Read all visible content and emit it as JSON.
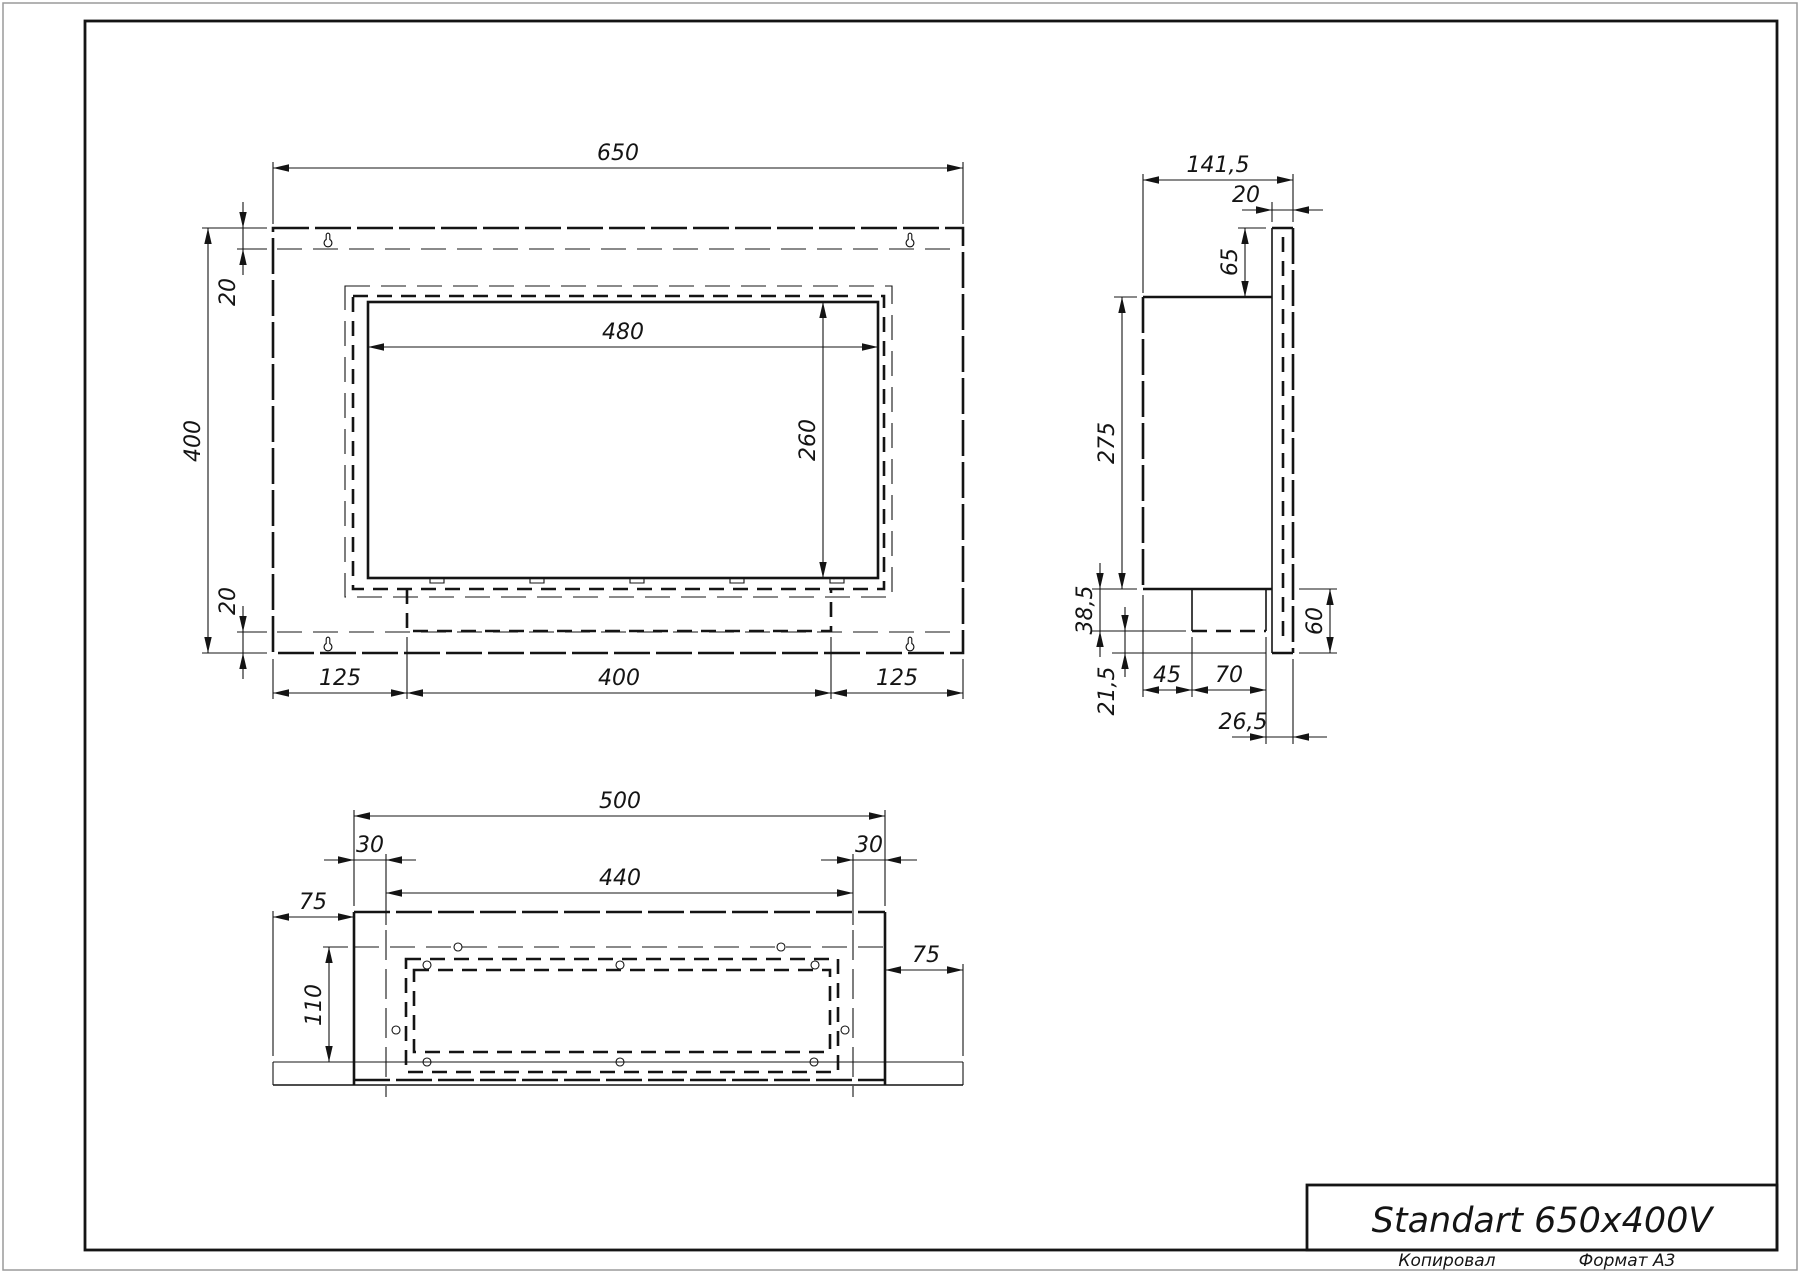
{
  "page": {
    "title_block": {
      "title": "Standart 650x400V"
    },
    "footer": {
      "copied": "Копировал",
      "format": "Формат А3"
    }
  },
  "views": {
    "front": {
      "dims": {
        "overall_width": "650",
        "overall_height": "400",
        "top_inset": "20",
        "bottom_inset": "20",
        "opening_width": "480",
        "opening_height": "260",
        "bottom_left": "125",
        "bottom_center": "400",
        "bottom_right": "125"
      }
    },
    "side": {
      "dims": {
        "overall_depth": "141,5",
        "front_flange": "20",
        "top_offset": "65",
        "box_height": "275",
        "tray_depth": "38,5",
        "bottom_lip": "21,5",
        "tray_offset": "45",
        "tray_width": "70",
        "outlet_offset": "26,5",
        "bottom_offset": "60"
      }
    },
    "bottom": {
      "dims": {
        "box_width": "500",
        "left_fold": "30",
        "inner_width": "440",
        "right_fold": "30",
        "left_margin": "75",
        "right_margin": "75",
        "box_depth": "110"
      }
    }
  }
}
